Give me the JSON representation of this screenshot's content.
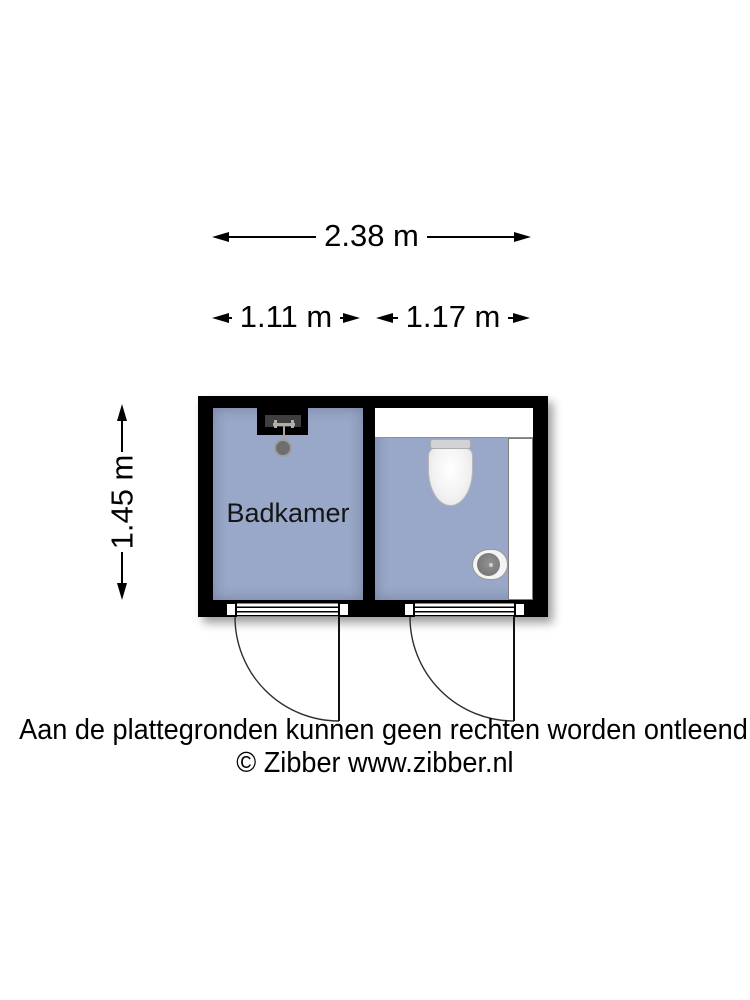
{
  "dimensions": {
    "total_width": "2.38 m",
    "left_room_width": "1.11 m",
    "right_room_width": "1.17 m",
    "height": "1.45 m"
  },
  "rooms": {
    "bathroom_label": "Badkamer"
  },
  "footer": {
    "disclaimer": "Aan de plattegronden kunnen geen rechten worden ontleend",
    "copyright": "© Zibber www.zibber.nl"
  },
  "colors": {
    "room_fill": "#99a8c8",
    "wall": "#000000",
    "niche_gray": "#3f3f3f",
    "shower_metal": "#b5aea6",
    "fixture_white": "#ffffff",
    "sink_bowl": "#6d6d6d"
  }
}
